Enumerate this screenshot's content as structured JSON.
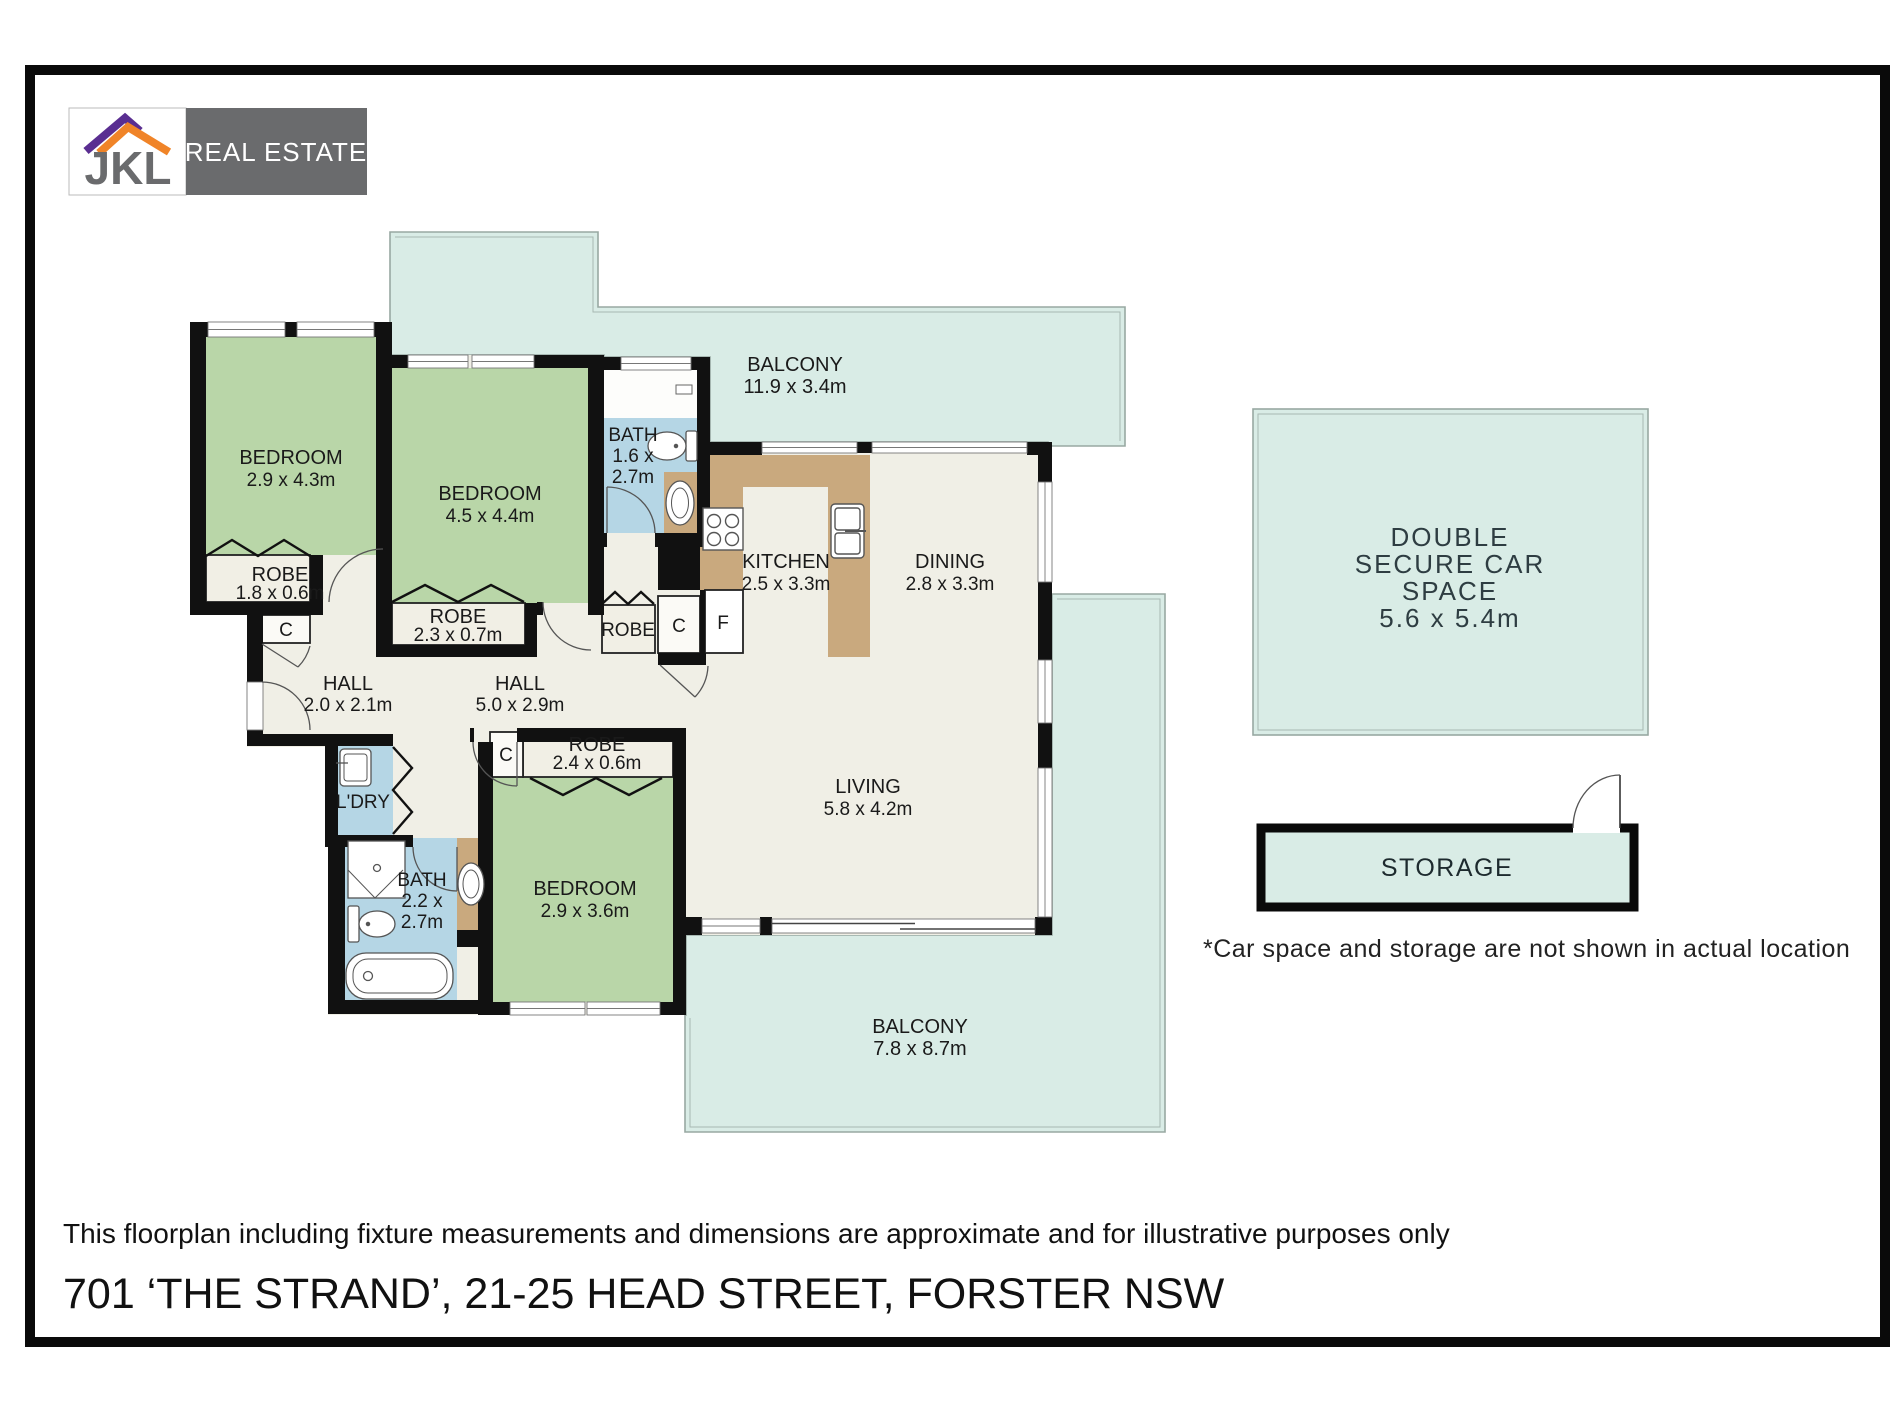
{
  "logo": {
    "brand": "JKL",
    "tagline": "REAL ESTATE"
  },
  "rooms": {
    "bedroom1": {
      "label": "BEDROOM",
      "dims": "2.9 x 4.3m"
    },
    "bedroom2": {
      "label": "BEDROOM",
      "dims": "4.5 x 4.4m"
    },
    "bedroom3": {
      "label": "BEDROOM",
      "dims": "2.9 x 3.6m"
    },
    "bath1": {
      "label": "BATH",
      "dims_line1": "1.6 x",
      "dims_line2": "2.7m"
    },
    "bath2": {
      "label": "BATH",
      "dims_line1": "2.2 x",
      "dims_line2": "2.7m"
    },
    "laundry": {
      "label": "L'DRY"
    },
    "kitchen": {
      "label": "KITCHEN",
      "dims": "2.5 x 3.3m"
    },
    "dining": {
      "label": "DINING",
      "dims": "2.8 x 3.3m"
    },
    "living": {
      "label": "LIVING",
      "dims": "5.8 x 4.2m"
    },
    "hall1": {
      "label": "HALL",
      "dims": "2.0 x 2.1m"
    },
    "hall2": {
      "label": "HALL",
      "dims": "5.0 x 2.9m"
    },
    "robe1": {
      "label": "ROBE",
      "dims": "1.8 x 0.6m"
    },
    "robe2": {
      "label": "ROBE",
      "dims": "2.3 x 0.7m"
    },
    "robe3": {
      "label": "ROBE",
      "dims": "2.4 x 0.6m"
    },
    "robe4": {
      "label": "ROBE"
    },
    "balcony_top": {
      "label": "BALCONY",
      "dims": "11.9 x 3.4m"
    },
    "balcony_bottom": {
      "label": "BALCONY",
      "dims": "7.8 x 8.7m"
    },
    "cupboard": {
      "label": "C"
    },
    "fridge": {
      "label": "F"
    },
    "carspace": {
      "line1": "DOUBLE",
      "line2": "SECURE CAR",
      "line3": "SPACE",
      "dims": "5.6 x 5.4m"
    },
    "storage": {
      "label": "STORAGE"
    }
  },
  "page": {
    "note": "*Car space and storage are not shown in actual location",
    "disclaimer": "This floorplan including fixture measurements and dimensions are approximate and for illustrative purposes only",
    "address": "701 ‘THE STRAND’, 21-25 HEAD STREET, FORSTER NSW"
  },
  "colors": {
    "wall": "#111111",
    "bedroom_green": "#b9d6a8",
    "balcony_teal": "#d9ece6",
    "bath_blue": "#b5d6e5",
    "counter_tan": "#c9a97e",
    "floor_cream": "#f0efe6",
    "logo_gray": "#6a6b6d",
    "logo_purple": "#5a2e91",
    "logo_orange": "#f08428"
  }
}
